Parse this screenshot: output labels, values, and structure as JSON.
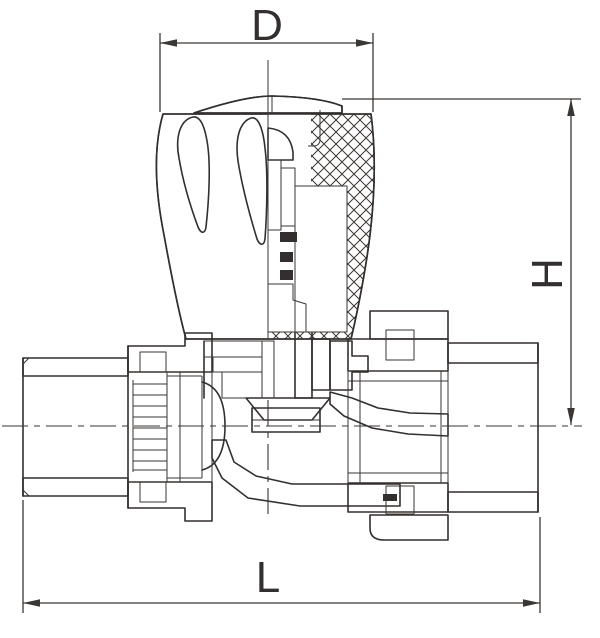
{
  "drawing": {
    "type": "technical-drawing",
    "subject": "straight valve cross-section",
    "background_color": "#ffffff",
    "line_color": "#332f2e",
    "dim_d": {
      "label": "D",
      "orientation": "horizontal",
      "position": "top"
    },
    "dim_h": {
      "label": "H",
      "orientation": "vertical",
      "position": "right"
    },
    "dim_l": {
      "label": "L",
      "orientation": "horizontal",
      "position": "bottom"
    }
  }
}
